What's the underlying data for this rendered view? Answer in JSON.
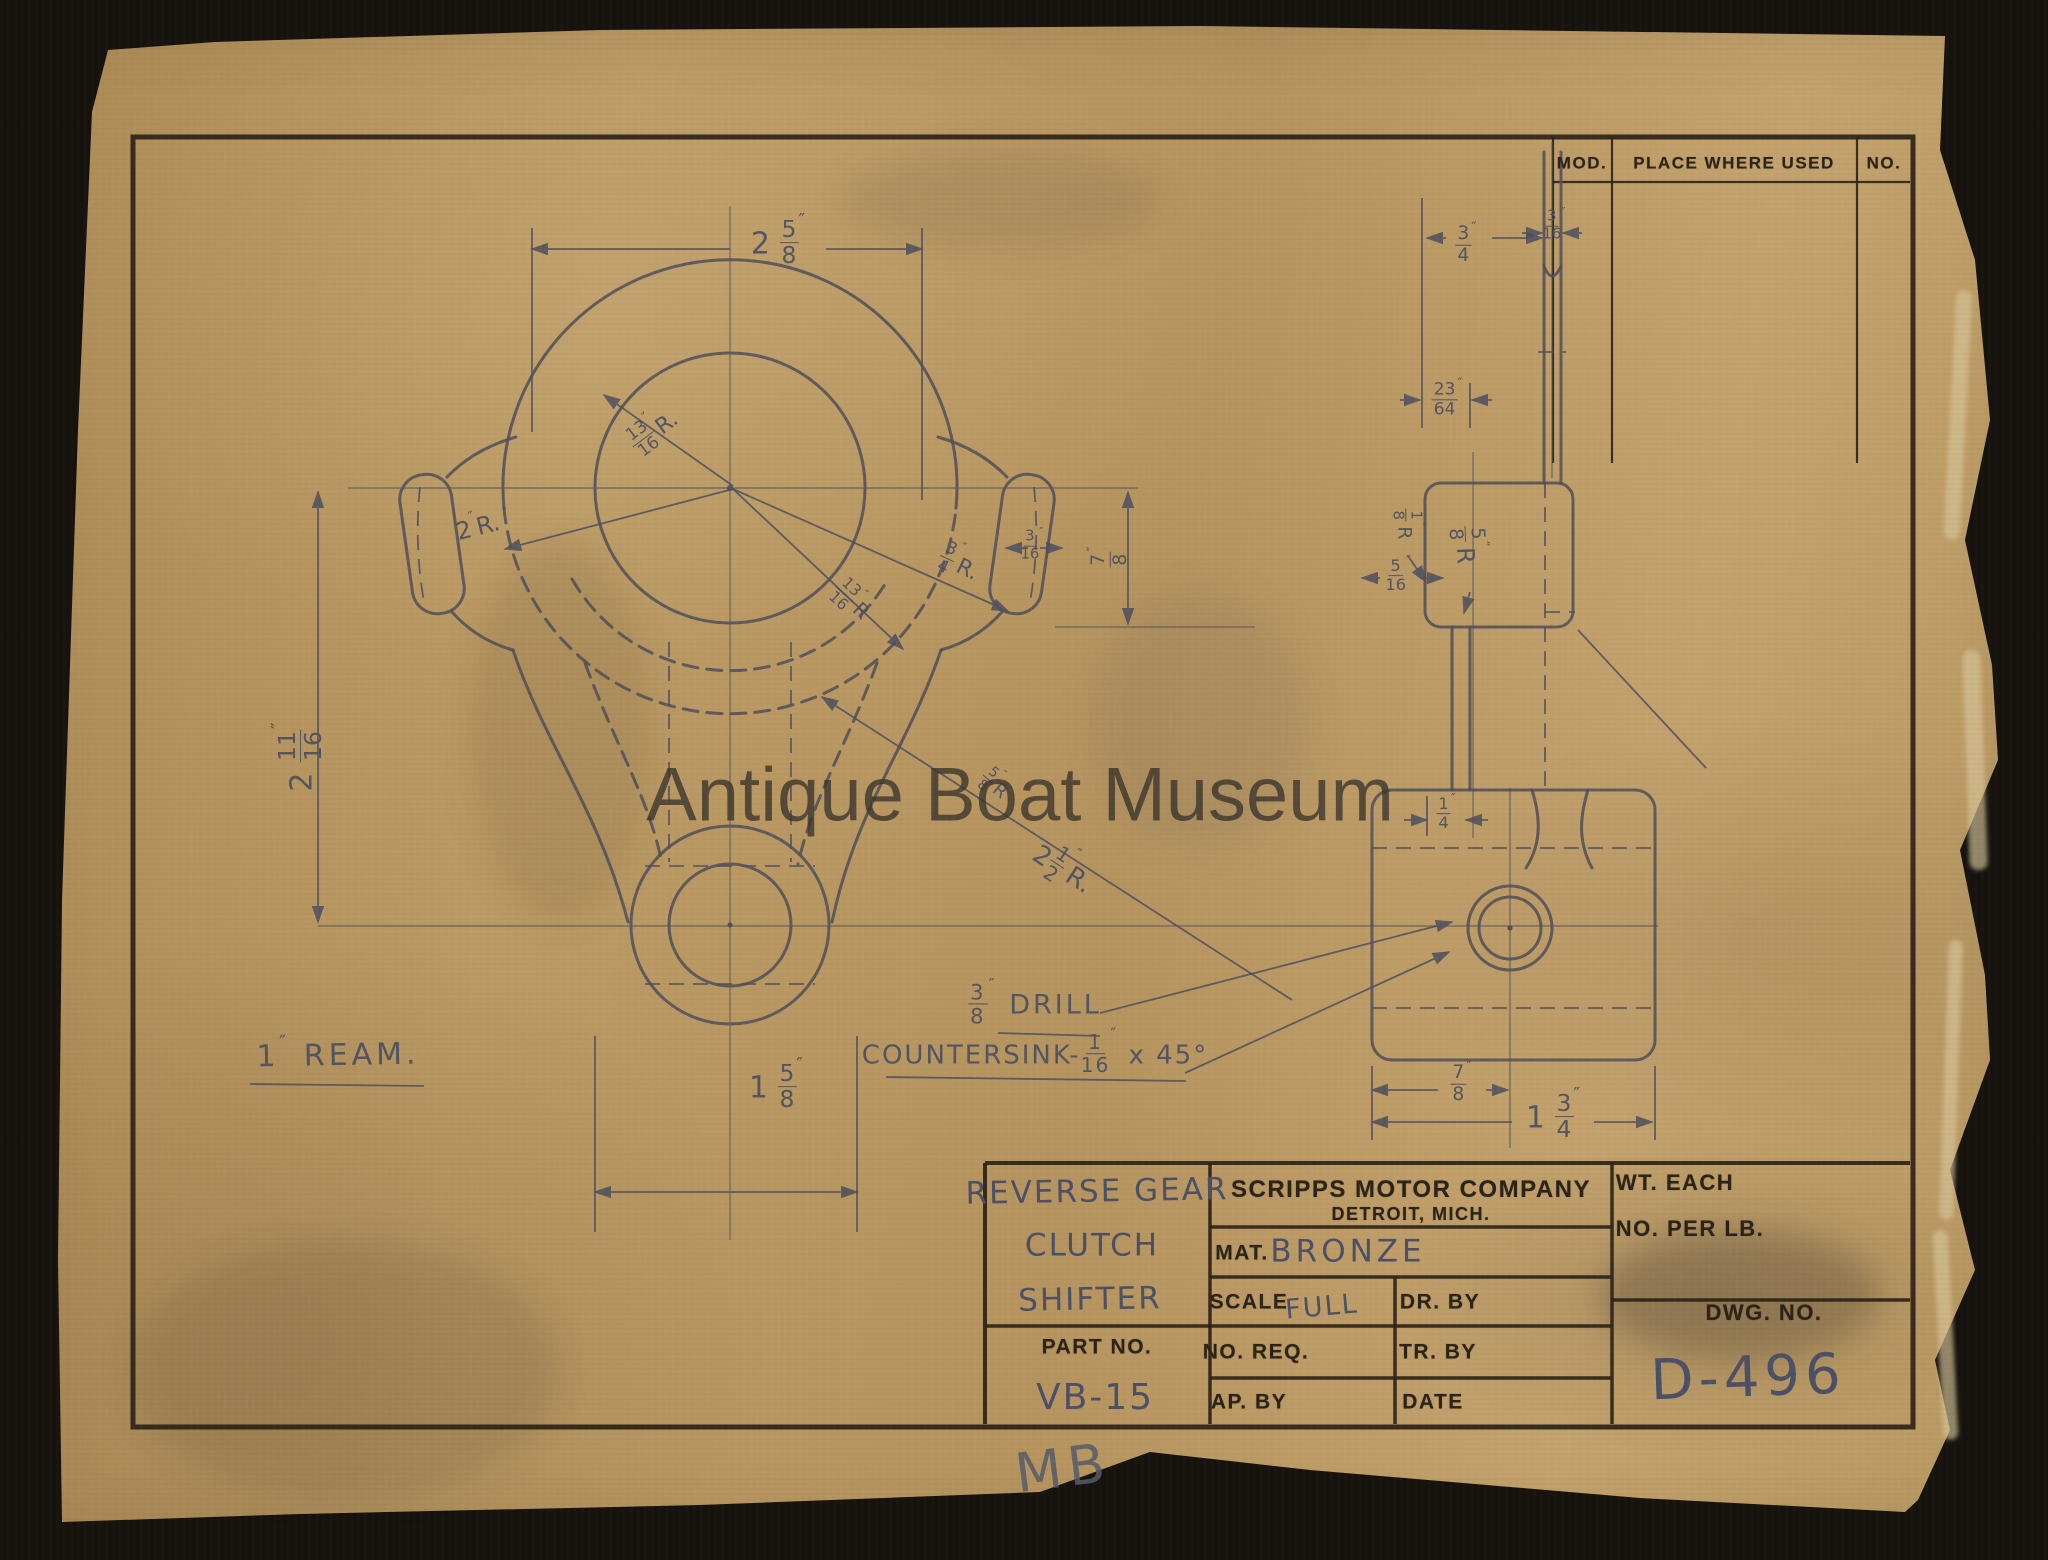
{
  "scan": {
    "museum_watermark": "Antique Boat Museum",
    "pencil_initials": "MB"
  },
  "colors": {
    "background": "#16120d",
    "paper": "#b6945f",
    "pencil": "#4d4f5e",
    "print_ink": "#2b2317"
  },
  "mod_table": {
    "headers": [
      "MOD.",
      "PLACE WHERE USED",
      "NO."
    ]
  },
  "title_block": {
    "part_name_lines": [
      "REVERSE GEAR",
      "CLUTCH",
      "SHIFTER"
    ],
    "part_no_label": "PART NO.",
    "part_no_value": "VB-15",
    "company_name": "SCRIPPS MOTOR COMPANY",
    "company_city": "DETROIT, MICH.",
    "mat_label": "MAT.",
    "mat_value": "BRONZE",
    "scale_label": "SCALE",
    "scale_value": "FULL",
    "dr_by_label": "DR. BY",
    "no_req_label": "NO. REQ.",
    "tr_by_label": "TR. BY",
    "ap_by_label": "AP. BY",
    "date_label": "DATE",
    "wt_each_label": "WT. EACH",
    "no_per_lb_label": "NO. PER LB.",
    "dwg_no_label": "DWG. NO.",
    "dwg_no_value": "D-496"
  },
  "annotations": [
    {
      "name": "dim-overall-width",
      "x": 778,
      "y": 245,
      "rot": 0,
      "size": 30,
      "parts": [
        {
          "t": "2 "
        },
        {
          "f": [
            "5",
            "8"
          ]
        },
        {
          "s": "″"
        }
      ]
    },
    {
      "name": "dim-bore-radius",
      "x": 655,
      "y": 433,
      "rot": -37,
      "size": 22,
      "parts": [
        {
          "f": [
            "13",
            "16"
          ]
        },
        {
          "s": "″"
        },
        {
          "t": "R."
        }
      ]
    },
    {
      "name": "dim-outer-radius",
      "x": 478,
      "y": 527,
      "rot": -14,
      "size": 24,
      "parts": [
        {
          "t": "2"
        },
        {
          "s": "″"
        },
        {
          "t": "R."
        }
      ]
    },
    {
      "name": "dim-fillet-radius",
      "x": 958,
      "y": 566,
      "rot": 25,
      "size": 22,
      "parts": [
        {
          "f": [
            "3",
            "4"
          ]
        },
        {
          "s": "″"
        },
        {
          "t": "R."
        }
      ]
    },
    {
      "name": "dim-inner-radius",
      "x": 850,
      "y": 602,
      "rot": 43,
      "size": 20,
      "parts": [
        {
          "f": [
            "13",
            "16"
          ]
        },
        {
          "s": "″"
        },
        {
          "t": "R"
        }
      ]
    },
    {
      "name": "dim-ear-width",
      "x": 1032,
      "y": 548,
      "rot": 0,
      "size": 19,
      "parts": [
        {
          "f": [
            "3",
            "16"
          ]
        },
        {
          "s": "″"
        }
      ]
    },
    {
      "name": "dim-ear-offset",
      "x": 1112,
      "y": 557,
      "rot": -90,
      "size": 24,
      "parts": [
        {
          "f": [
            "7",
            "8"
          ]
        },
        {
          "s": "″"
        }
      ]
    },
    {
      "name": "dim-center-distance",
      "x": 303,
      "y": 757,
      "rot": -90,
      "size": 30,
      "parts": [
        {
          "t": "2 "
        },
        {
          "f": [
            "11",
            "16"
          ]
        },
        {
          "s": "″"
        }
      ]
    },
    {
      "name": "dim-hub-width",
      "x": 776,
      "y": 1089,
      "rot": 0,
      "size": 30,
      "parts": [
        {
          "t": "1 "
        },
        {
          "f": [
            "5",
            "8"
          ]
        },
        {
          "s": "″"
        }
      ]
    },
    {
      "name": "note-ream",
      "x": 338,
      "y": 1056,
      "rot": -1,
      "size": 30,
      "sp": 4,
      "parts": [
        {
          "t": "1"
        },
        {
          "s": "″"
        },
        {
          "t": " REAM."
        }
      ]
    },
    {
      "name": "dim-yoke-radius",
      "x": 1062,
      "y": 870,
      "rot": 33,
      "size": 26,
      "parts": [
        {
          "t": "2"
        },
        {
          "f": [
            "1",
            "2"
          ]
        },
        {
          "s": "″"
        },
        {
          "t": "R."
        }
      ]
    },
    {
      "name": "dim-yoke-small-radius",
      "x": 993,
      "y": 786,
      "rot": 40,
      "size": 18,
      "parts": [
        {
          "f": [
            "5",
            "8"
          ]
        },
        {
          "s": "″"
        },
        {
          "t": "R"
        }
      ]
    },
    {
      "name": "note-drill",
      "x": 1035,
      "y": 1006,
      "rot": 0,
      "size": 27,
      "sp": 3,
      "parts": [
        {
          "f": [
            "3",
            "8"
          ]
        },
        {
          "s": "″"
        },
        {
          "t": " DRILL"
        }
      ]
    },
    {
      "name": "note-countersink",
      "x": 1035,
      "y": 1056,
      "rot": 0,
      "size": 26,
      "sp": 2,
      "parts": [
        {
          "t": "COUNTERSINK-"
        },
        {
          "f": [
            "1",
            "16"
          ]
        },
        {
          "s": "″"
        },
        {
          "t": " x 45°"
        }
      ]
    },
    {
      "name": "dim-side-top-width",
      "x": 1466,
      "y": 247,
      "rot": 0,
      "size": 24,
      "parts": [
        {
          "f": [
            "3",
            "4"
          ]
        },
        {
          "s": "″"
        }
      ]
    },
    {
      "name": "dim-side-stem-width",
      "x": 1554,
      "y": 228,
      "rot": 0,
      "size": 19,
      "parts": [
        {
          "f": [
            "3",
            "16"
          ]
        },
        {
          "s": "″"
        }
      ]
    },
    {
      "name": "dim-side-slot",
      "x": 1447,
      "y": 402,
      "rot": 0,
      "size": 22,
      "parts": [
        {
          "f": [
            "23",
            "64"
          ]
        },
        {
          "s": "″"
        }
      ]
    },
    {
      "name": "dim-side-block-offset",
      "x": 1398,
      "y": 578,
      "rot": 0,
      "size": 21,
      "parts": [
        {
          "f": [
            "5",
            "16"
          ]
        },
        {
          "s": "″"
        }
      ]
    },
    {
      "name": "dim-side-fillet-a",
      "x": 1404,
      "y": 524,
      "rot": 90,
      "size": 19,
      "parts": [
        {
          "f": [
            "1",
            "8"
          ]
        },
        {
          "s": "″"
        },
        {
          "t": "R"
        }
      ]
    },
    {
      "name": "dim-side-fillet-b",
      "x": 1464,
      "y": 545,
      "rot": 88,
      "size": 24,
      "parts": [
        {
          "f": [
            "5",
            "8"
          ]
        },
        {
          "s": "″"
        },
        {
          "t": "R"
        }
      ]
    },
    {
      "name": "dim-side-finger",
      "x": 1446,
      "y": 816,
      "rot": 0,
      "size": 21,
      "parts": [
        {
          "f": [
            "1",
            "4"
          ]
        },
        {
          "s": "″"
        }
      ]
    },
    {
      "name": "dim-side-hole-offset",
      "x": 1461,
      "y": 1086,
      "rot": 0,
      "size": 24,
      "parts": [
        {
          "f": [
            "7",
            "8"
          ]
        },
        {
          "s": "″"
        }
      ]
    },
    {
      "name": "dim-side-plate-width",
      "x": 1553,
      "y": 1119,
      "rot": 0,
      "size": 30,
      "parts": [
        {
          "t": "1 "
        },
        {
          "f": [
            "3",
            "4"
          ]
        },
        {
          "s": "″"
        }
      ]
    }
  ]
}
